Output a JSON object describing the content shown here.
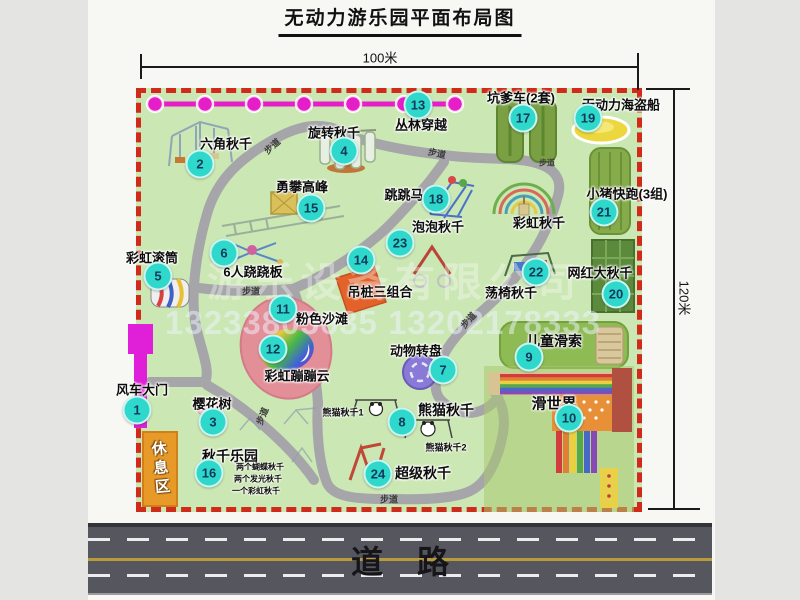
{
  "title": "无动力游乐园平面布局图",
  "dimensions": {
    "width_label": "100米",
    "height_label": "120米"
  },
  "road": {
    "label": "道路"
  },
  "watermark": {
    "company": "游乐设备有限公司",
    "phone": "13233805635 13202178333"
  },
  "colors": {
    "badge_bg": "#2ed8cb",
    "badge_text": "#123a5c",
    "map_bg": "#cbe7b3",
    "border_red": "#d02a1a",
    "path_gray": "#a5a5aa",
    "beadline_magenta": "#e61ec8",
    "road_gray": "#56565e",
    "lane_yellow": "#b89c3c"
  },
  "pois": [
    {
      "num": "1",
      "name": "风车大门",
      "badge": {
        "x": 137,
        "y": 410
      },
      "label": {
        "x": 142,
        "y": 389
      },
      "size": 13
    },
    {
      "num": "2",
      "name": "六角秋千",
      "badge": {
        "x": 200,
        "y": 164
      },
      "label": {
        "x": 226,
        "y": 143
      },
      "size": 13
    },
    {
      "num": "3",
      "name": "樱花树",
      "badge": {
        "x": 213,
        "y": 422
      },
      "label": {
        "x": 212,
        "y": 403
      },
      "size": 13
    },
    {
      "num": "4",
      "name": "旋转秋千",
      "badge": {
        "x": 344,
        "y": 151
      },
      "label": {
        "x": 334,
        "y": 132
      },
      "size": 13
    },
    {
      "num": "5",
      "name": "彩虹滚筒",
      "badge": {
        "x": 158,
        "y": 276
      },
      "label": {
        "x": 152,
        "y": 257
      },
      "size": 13
    },
    {
      "num": "6",
      "name": "6人跷跷板",
      "badge": {
        "x": 224,
        "y": 253
      },
      "label": {
        "x": 253,
        "y": 271
      },
      "size": 13
    },
    {
      "num": "7",
      "name": "动物转盘",
      "badge": {
        "x": 443,
        "y": 370
      },
      "label": {
        "x": 416,
        "y": 350
      },
      "size": 13
    },
    {
      "num": "8",
      "name": "熊猫秋千",
      "badge": {
        "x": 402,
        "y": 422
      },
      "label": {
        "x": 446,
        "y": 410
      },
      "size": 14
    },
    {
      "num": "9",
      "name": "儿童滑索",
      "badge": {
        "x": 529,
        "y": 357
      },
      "label": {
        "x": 554,
        "y": 341
      },
      "size": 14
    },
    {
      "num": "10",
      "name": "滑世界",
      "badge": {
        "x": 569,
        "y": 418
      },
      "label": {
        "x": 554,
        "y": 403
      },
      "size": 15
    },
    {
      "num": "11",
      "name": "粉色沙滩",
      "badge": {
        "x": 283,
        "y": 309
      },
      "label": {
        "x": 322,
        "y": 318
      },
      "size": 13
    },
    {
      "num": "12",
      "name": "彩虹蹦蹦云",
      "badge": {
        "x": 273,
        "y": 349
      },
      "label": {
        "x": 297,
        "y": 375
      },
      "size": 13
    },
    {
      "num": "13",
      "name": "丛林穿越",
      "badge": {
        "x": 418,
        "y": 105
      },
      "label": {
        "x": 421,
        "y": 124
      },
      "size": 13
    },
    {
      "num": "14",
      "name": "吊桩三组合",
      "badge": {
        "x": 361,
        "y": 260
      },
      "label": {
        "x": 380,
        "y": 291
      },
      "size": 13
    },
    {
      "num": "15",
      "name": "勇攀高峰",
      "badge": {
        "x": 311,
        "y": 208
      },
      "label": {
        "x": 302,
        "y": 186
      },
      "size": 13
    },
    {
      "num": "16",
      "name": "秋千乐园",
      "badge": {
        "x": 209,
        "y": 473
      },
      "label": {
        "x": 230,
        "y": 456
      },
      "size": 14
    },
    {
      "num": "17",
      "name": "坑爹车(2套)",
      "badge": {
        "x": 523,
        "y": 118
      },
      "label": {
        "x": 521,
        "y": 97
      },
      "size": 13
    },
    {
      "num": "18",
      "name": "跳跳马",
      "badge": {
        "x": 436,
        "y": 199
      },
      "label": {
        "x": 404,
        "y": 194
      },
      "size": 13
    },
    {
      "num": "19",
      "name": "无动力海盗船",
      "badge": {
        "x": 588,
        "y": 118
      },
      "label": {
        "x": 621,
        "y": 104
      },
      "size": 13
    },
    {
      "num": "20",
      "name": "网红大秋千",
      "badge": {
        "x": 616,
        "y": 294
      },
      "label": {
        "x": 600,
        "y": 272
      },
      "size": 13
    },
    {
      "num": "21",
      "name": "小猪快跑(3组)",
      "badge": {
        "x": 604,
        "y": 212
      },
      "label": {
        "x": 627,
        "y": 193
      },
      "size": 13
    },
    {
      "num": "22",
      "name": "荡椅秋千",
      "badge": {
        "x": 536,
        "y": 272
      },
      "label": {
        "x": 511,
        "y": 292
      },
      "size": 13
    },
    {
      "num": "23",
      "name": "泡泡秋千",
      "badge": {
        "x": 400,
        "y": 243
      },
      "label": {
        "x": 438,
        "y": 226
      },
      "size": 13
    },
    {
      "num": "24",
      "name": "超级秋千",
      "badge": {
        "x": 378,
        "y": 474
      },
      "label": {
        "x": 423,
        "y": 473
      },
      "size": 14
    }
  ],
  "extra_labels": [
    {
      "text": "彩虹秋千",
      "x": 539,
      "y": 222,
      "size": 13,
      "cls": "note-label"
    },
    {
      "text": "熊猫秋千1",
      "x": 343,
      "y": 412,
      "size": 9,
      "cls": "note-label"
    },
    {
      "text": "熊猫秋千2",
      "x": 446,
      "y": 447,
      "size": 9,
      "cls": "note-label"
    },
    {
      "text": "两个蝴蝶秋千",
      "x": 260,
      "y": 467,
      "size": 8,
      "cls": "note-label"
    },
    {
      "text": "两个发光秋千",
      "x": 258,
      "y": 479,
      "size": 8,
      "cls": "note-label"
    },
    {
      "text": "一个彩虹秋千",
      "x": 256,
      "y": 491,
      "size": 8,
      "cls": "note-label"
    },
    {
      "text": "休息区",
      "x": 160,
      "y": 469,
      "size": 15,
      "cls": "note-label vertical",
      "rot": -5
    },
    {
      "text": "步道",
      "x": 272,
      "y": 146,
      "size": 9,
      "cls": "note-label trail",
      "rot": -42
    },
    {
      "text": "步道",
      "x": 437,
      "y": 153,
      "size": 9,
      "cls": "note-label trail",
      "rot": 12
    },
    {
      "text": "步道",
      "x": 547,
      "y": 163,
      "size": 8,
      "cls": "note-label trail"
    },
    {
      "text": "步道",
      "x": 251,
      "y": 291,
      "size": 9,
      "cls": "note-label trail"
    },
    {
      "text": "步道",
      "x": 468,
      "y": 320,
      "size": 9,
      "cls": "note-label trail",
      "rot": -48
    },
    {
      "text": "步道",
      "x": 262,
      "y": 416,
      "size": 9,
      "cls": "note-label trail",
      "rot": -68
    },
    {
      "text": "步道",
      "x": 389,
      "y": 499,
      "size": 9,
      "cls": "note-label trail"
    }
  ]
}
